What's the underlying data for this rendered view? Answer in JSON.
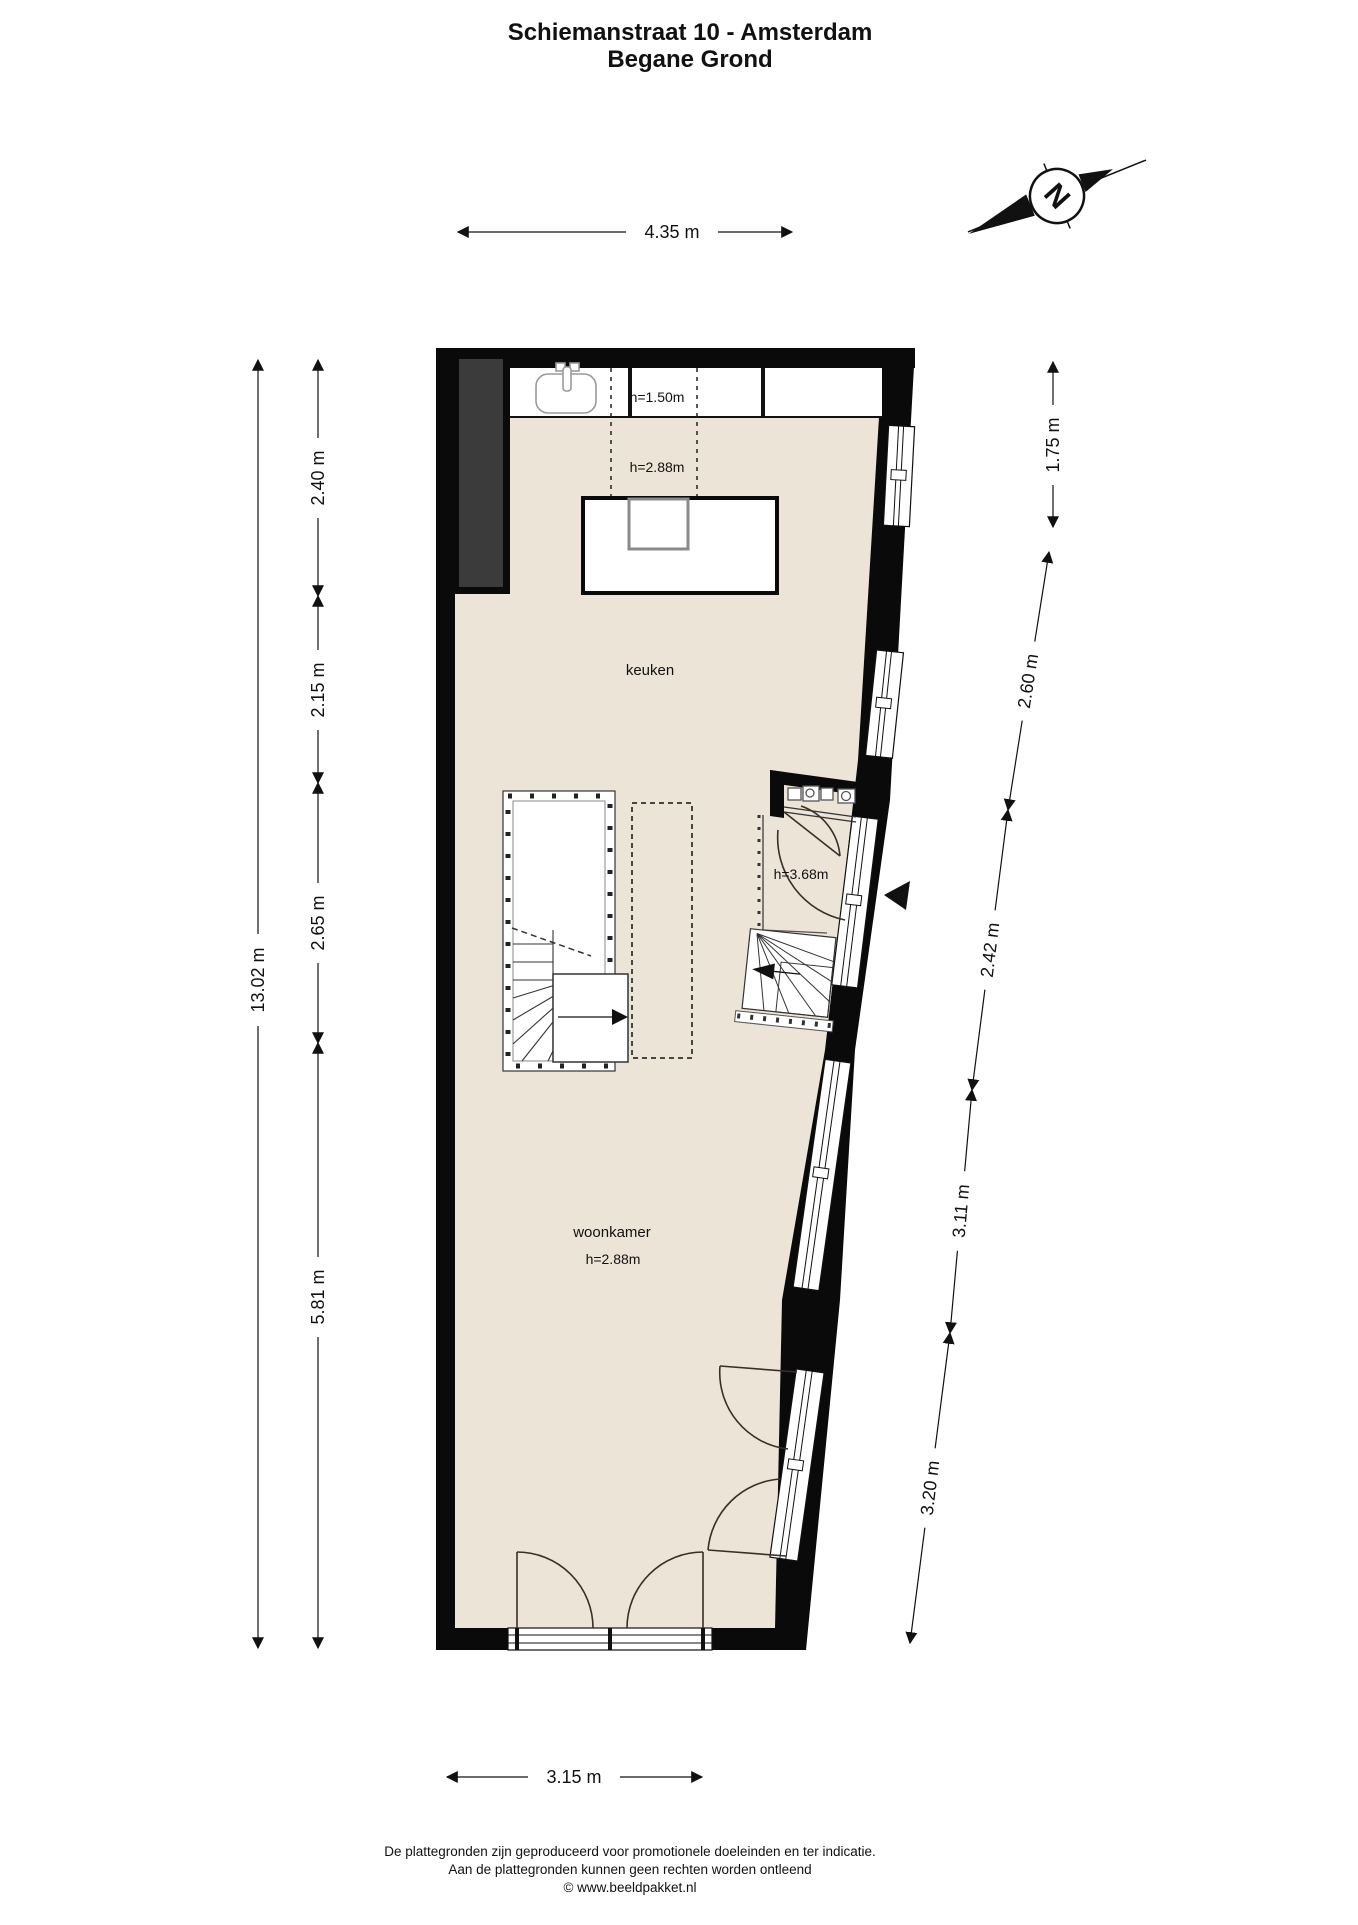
{
  "title": {
    "line1": "Schiemanstraat 10 - Amsterdam",
    "line2": "Begane Grond"
  },
  "compass": {
    "label": "N"
  },
  "rooms": {
    "keuken": "keuken",
    "woonkamer": "woonkamer"
  },
  "heights": {
    "counter": "h=1.50m",
    "kitchen": "h=2.88m",
    "living": "h=2.88m",
    "entree": "h=3.68m"
  },
  "dimensions": {
    "top": "4.35 m",
    "bottom": "3.15 m",
    "left_total": "13.02 m",
    "left_segments": [
      "2.40 m",
      "2.15 m",
      "2.65 m",
      "5.81 m"
    ],
    "right_segments": [
      "1.75 m",
      "2.60 m",
      "2.42 m",
      "3.11 m",
      "3.20 m"
    ]
  },
  "footer": {
    "line1": "De plattegronden zijn geproduceerd voor promotionele doeleinden en ter indicatie.",
    "line2": "Aan de plattegronden kunnen geen rechten worden ontleend",
    "line3": "© www.beeldpakket.nl"
  },
  "colors": {
    "floor": "#ece4d7",
    "wall": "#0a0a0a",
    "chimney": "#3b3b3b"
  }
}
